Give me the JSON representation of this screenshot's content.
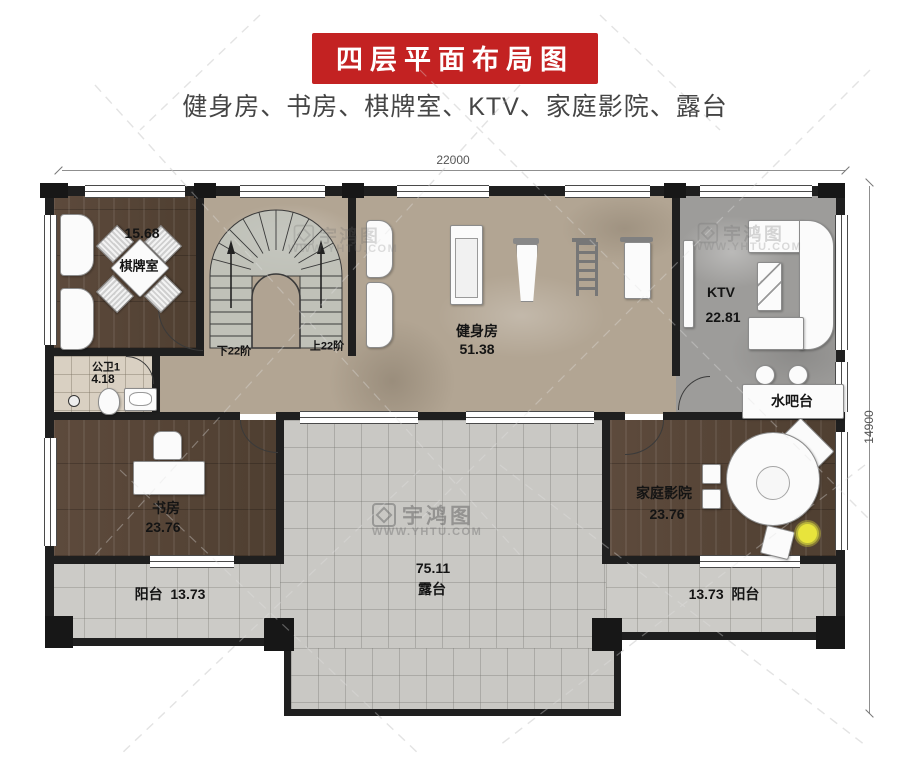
{
  "header": {
    "title": "四层平面布局图",
    "subtitle": "健身房、书房、棋牌室、KTV、家庭影院、露台"
  },
  "dimensions": {
    "top": "22000",
    "right": "14900"
  },
  "rooms": {
    "chess": {
      "name": "棋牌室",
      "area": "15.68"
    },
    "bathroom": {
      "name": "公卫1",
      "area": "4.18"
    },
    "gym": {
      "name": "健身房",
      "area": "51.38"
    },
    "ktv": {
      "name": "KTV",
      "area": "22.81"
    },
    "bar": {
      "name": "水吧台"
    },
    "study": {
      "name": "书房",
      "area": "23.76"
    },
    "theater": {
      "name": "家庭影院",
      "area": "23.76"
    },
    "terrace": {
      "name": "露台",
      "area": "75.11"
    },
    "balcony_left": {
      "name": "阳台",
      "area": "13.73"
    },
    "balcony_right": {
      "name": "阳台",
      "area": "13.73"
    }
  },
  "stairs": {
    "down": "下22阶",
    "up": "上22阶"
  },
  "watermark": {
    "brand": "宇鸿图",
    "url": "WWW.YHTU.COM"
  },
  "colors": {
    "accent_red": "#c32222",
    "wall": "#1f1f1f",
    "wood": "#57453a",
    "marble": "#b2a593",
    "tile": "#c9c8c4",
    "ktv_floor": "#9d9c9a",
    "lamp_yellow": "#e8e43c"
  }
}
